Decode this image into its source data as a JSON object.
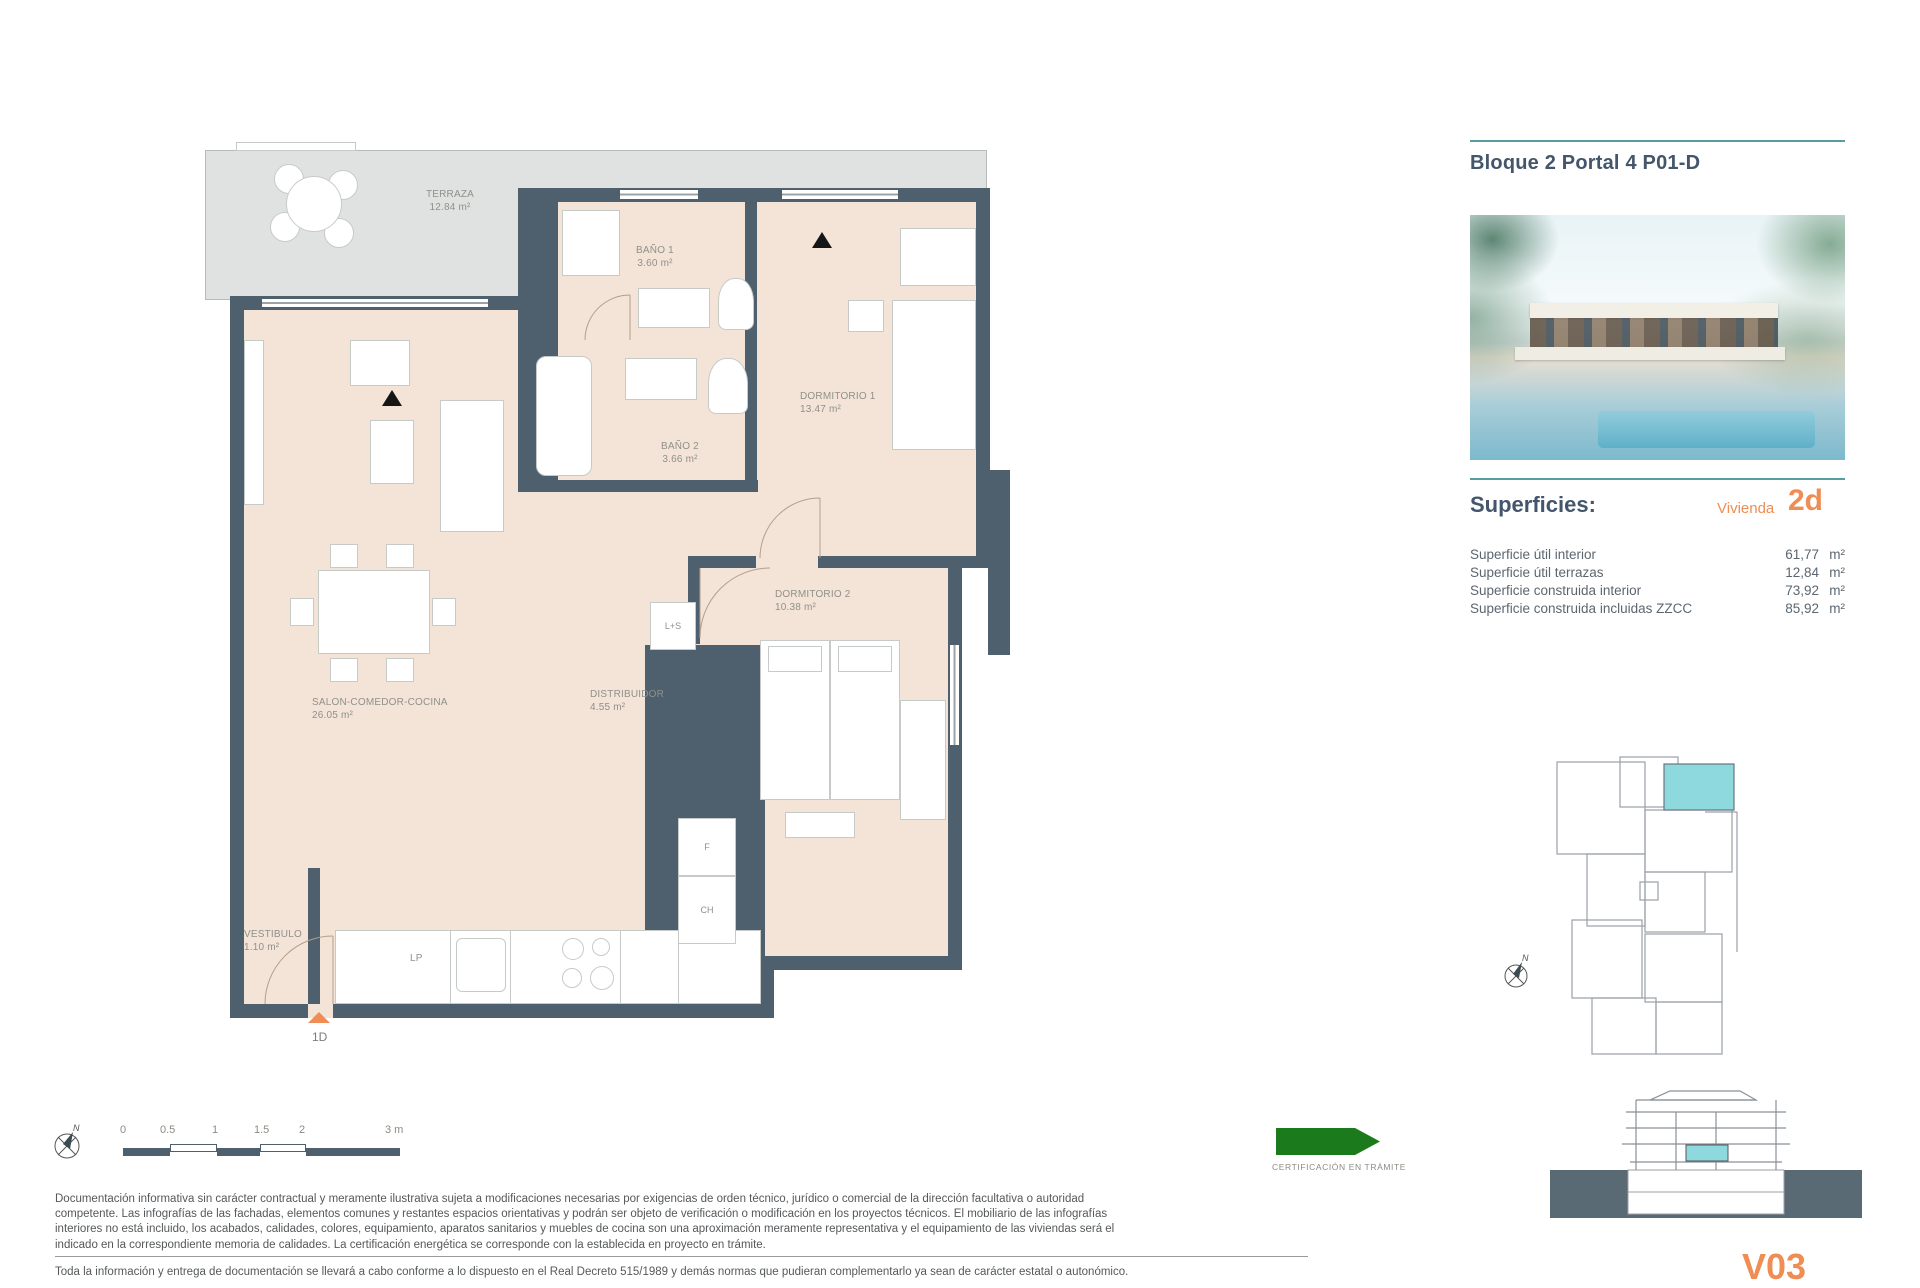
{
  "header": {
    "title": "Bloque 2 Portal 4 P01-D"
  },
  "superficies": {
    "heading": "Superficies:",
    "vivienda_label": "Vivienda",
    "vivienda_code": "2d",
    "unit": "m²",
    "rows": [
      {
        "label": "Superficie útil interior",
        "value": "61,77"
      },
      {
        "label": "Superficie útil terrazas",
        "value": "12,84"
      },
      {
        "label": "Superficie construida interior",
        "value": "73,92"
      },
      {
        "label": "Superficie construida incluidas ZZCC",
        "value": "85,92"
      }
    ]
  },
  "plan": {
    "rooms": {
      "terraza": {
        "name": "TERRAZA",
        "area": "12.84 m²"
      },
      "bano1": {
        "name": "BAÑO 1",
        "area": "3.60 m²"
      },
      "dormitorio1": {
        "name": "DORMITORIO 1",
        "area": "13.47 m²"
      },
      "bano2": {
        "name": "BAÑO 2",
        "area": "3.66 m²"
      },
      "salon": {
        "name": "SALON-COMEDOR-COCINA",
        "area": "26.05 m²"
      },
      "distribuidor": {
        "name": "DISTRIBUIDOR",
        "area": "4.55 m²"
      },
      "dormitorio2": {
        "name": "DORMITORIO 2",
        "area": "10.38 m²"
      },
      "vestibulo": {
        "name": "VESTIBULO",
        "area": "1.10 m²"
      }
    },
    "markers": {
      "entry": "1D",
      "lp": "LP",
      "f": "F",
      "ch": "CH",
      "ls": "L+S"
    }
  },
  "scalebar": {
    "labels": [
      "0",
      "0.5",
      "1",
      "1.5",
      "2",
      "3 m"
    ],
    "north": "N"
  },
  "certification": {
    "label": "CERTIFICACIÓN EN TRÁMITE"
  },
  "legal": {
    "p1": "Documentación informativa sin carácter contractual y meramente ilustrativa sujeta a modificaciones necesarias por exigencias de orden técnico, jurídico o comercial de la dirección facultativa o autoridad competente. Las infografías de las fachadas, elementos comunes y restantes espacios orientativas y podrán ser objeto de verificación o modificación en los proyectos técnicos. El mobiliario de las infografías interiores no está incluido, los acabados, calidades, colores, equipamiento, aparatos sanitarios y muebles de cocina son una aproximación meramente representativa y el equipamiento de las viviendas será el indicado en la correspondiente memoria de calidades. La certificación energética se corresponde con la establecida en proyecto en trámite.",
    "p2": "Toda la información y entrega de documentación se llevará a cabo conforme a lo dispuesto en el Real Decreto 515/1989 y demás normas que pudieran complementarlo ya sean de carácter estatal o autonómico."
  },
  "version": "V03",
  "colors": {
    "wall": "#4e5f6e",
    "room": "#f3e4d7",
    "terrace": "#e0e2e1",
    "teal": "#569da1",
    "orange": "#ef8d55",
    "highlight": "#8ed9de",
    "green": "#1b7a1c"
  }
}
